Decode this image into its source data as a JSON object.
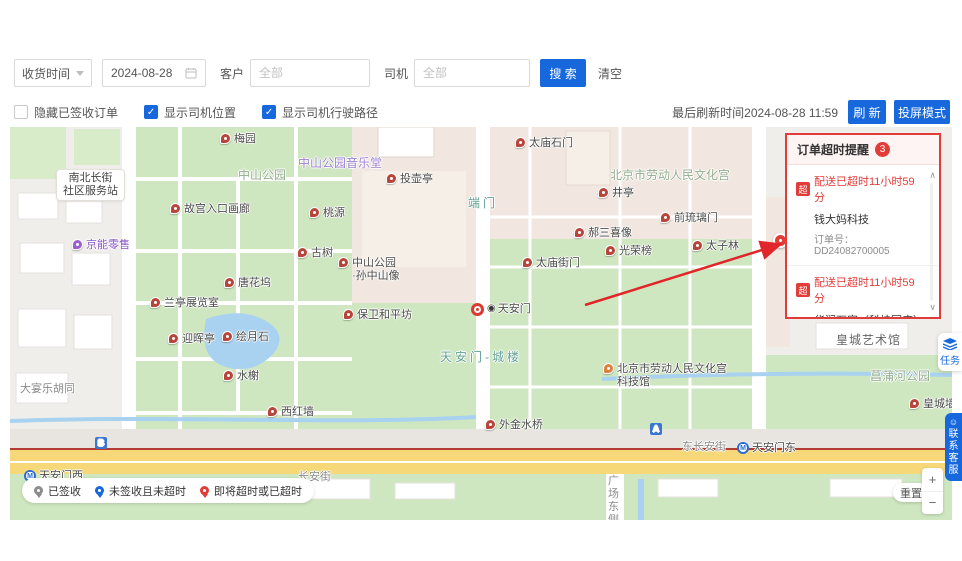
{
  "toolbar": {
    "filter_type": "收货时间",
    "date": "2024-08-28",
    "customer_label": "客户",
    "customer_placeholder": "全部",
    "driver_label": "司机",
    "driver_placeholder": "全部",
    "search_label": "搜 索",
    "clear_label": "清空"
  },
  "options": {
    "hide_signed_label": "隐藏已签收订单",
    "show_location_label": "显示司机位置",
    "show_route_label": "显示司机行驶路径",
    "last_refresh": "最后刷新时间2024-08-28 11:59",
    "refresh_label": "刷 新",
    "cast_label": "投屏模式"
  },
  "alert_panel": {
    "title": "订单超时提醒",
    "count": "3",
    "items": [
      {
        "tag": "超",
        "status": "配送已超时11小时59分",
        "customer": "钱大妈科技",
        "order_no": "订单号：DD24082700005"
      },
      {
        "tag": "超",
        "status": "配送已超时11小时59分",
        "customer": "华润万家（科技园店）2",
        "order_no": "订单号：DD24082700003"
      },
      {
        "tag": "超",
        "status": "剩余0分",
        "customer": "华润万家（科技园店）2",
        "order_no": ""
      }
    ]
  },
  "legend": [
    {
      "label": "已签收",
      "color": "#8c8c8c"
    },
    {
      "label": "未签收且未超时",
      "color": "#1668dc"
    },
    {
      "label": "即将超时或已超时",
      "color": "#e23c39"
    }
  ],
  "side": {
    "task_label": "任务",
    "service_label": "联系客服"
  },
  "controls": {
    "reset_label": "重置"
  },
  "icons": {
    "check": "✓",
    "plus": "+",
    "minus": "−",
    "scroll_up": "∧",
    "scroll_down": "∨",
    "smiley": "☺",
    "metro": "M",
    "attraction": "◉"
  },
  "colors": {
    "primary_blue": "#1668dc",
    "alert_red": "#e23c39",
    "park_green": "#cfe7c0",
    "road_yellow": "#f6d879",
    "river_blue": "#a9d2f1"
  },
  "map": {
    "labels": [
      {
        "t": "area",
        "v": "green",
        "x": 228,
        "y": 42,
        "s": "中山公园",
        "n": "area-label-zhongshan-park"
      },
      {
        "t": "area",
        "v": "purple",
        "x": 288,
        "y": 30,
        "s": "中山公园音乐堂",
        "n": "area-label-concert-hall"
      },
      {
        "t": "area",
        "v": "green",
        "x": 600,
        "y": 42,
        "s": "北京市劳动人民文化宫",
        "n": "area-label-working-peoples-palace"
      },
      {
        "t": "area",
        "v": "teal",
        "x": 458,
        "y": 70,
        "s": "端门",
        "n": "area-label-duanmen"
      },
      {
        "t": "area",
        "v": "teal",
        "x": 430,
        "y": 224,
        "s": "天安门-城楼",
        "n": "area-label-tiananmen-tower"
      },
      {
        "t": "area",
        "v": "green",
        "x": 860,
        "y": 243,
        "s": "菖蒲河公园",
        "n": "area-label-changpu-river-park"
      },
      {
        "t": "area",
        "v": "dark",
        "x": 826,
        "y": 207,
        "s": "皇城艺术馆",
        "n": "area-label-imperial-art-museum"
      },
      {
        "t": "area",
        "v": "street",
        "x": 10,
        "y": 256,
        "s": "大宴乐胡同",
        "n": "street-label-dayanle-hutong"
      },
      {
        "t": "area",
        "v": "street",
        "x": 288,
        "y": 344,
        "s": "长安街",
        "n": "street-label-changan-street"
      },
      {
        "t": "area",
        "v": "street",
        "x": 672,
        "y": 314,
        "s": "东长安街",
        "n": "street-label-east-changan-street"
      },
      {
        "t": "area",
        "v": "vstreet",
        "x": 598,
        "y": 348,
        "s": "广场东侧",
        "n": "street-label-square-east-road"
      },
      {
        "t": "bubble",
        "x": 46,
        "y": 42,
        "s": "南北长街",
        "s2": "社区服务站",
        "n": "bubble-label-community-station"
      },
      {
        "t": "poi",
        "x": 210,
        "y": 6,
        "s": "梅园"
      },
      {
        "t": "poi",
        "x": 376,
        "y": 46,
        "s": "投壶亭"
      },
      {
        "t": "poi",
        "x": 505,
        "y": 10,
        "s": "太庙石门"
      },
      {
        "t": "poi",
        "x": 160,
        "y": 76,
        "s": "故宫入口画廊"
      },
      {
        "t": "poi",
        "x": 299,
        "y": 80,
        "s": "桃源"
      },
      {
        "t": "poi",
        "x": 287,
        "y": 120,
        "s": "古树"
      },
      {
        "t": "poi",
        "x": 214,
        "y": 150,
        "s": "唐花坞"
      },
      {
        "t": "poi",
        "x": 140,
        "y": 170,
        "s": "兰亭展览室"
      },
      {
        "t": "poi",
        "x": 328,
        "y": 130,
        "s": "中山公园",
        "s2": "·孙中山像"
      },
      {
        "t": "poi",
        "x": 333,
        "y": 182,
        "s": "保卫和平坊"
      },
      {
        "t": "poi",
        "x": 158,
        "y": 206,
        "s": "迎晖亭"
      },
      {
        "t": "poi",
        "x": 212,
        "y": 204,
        "s": "绘月石"
      },
      {
        "t": "poi",
        "x": 213,
        "y": 243,
        "s": "水榭"
      },
      {
        "t": "poi",
        "x": 257,
        "y": 279,
        "s": "西红墙"
      },
      {
        "t": "poi",
        "x": 512,
        "y": 130,
        "s": "太庙街门"
      },
      {
        "t": "poi",
        "x": 588,
        "y": 60,
        "s": "井亭"
      },
      {
        "t": "poi",
        "x": 650,
        "y": 85,
        "s": "前琉璃门"
      },
      {
        "t": "poi",
        "x": 564,
        "y": 100,
        "s": "郝三喜像"
      },
      {
        "t": "poi",
        "x": 595,
        "y": 118,
        "s": "光荣榜"
      },
      {
        "t": "poi",
        "x": 682,
        "y": 113,
        "s": "太子林"
      },
      {
        "t": "poi",
        "x": 475,
        "y": 292,
        "s": "外金水桥"
      },
      {
        "t": "poi",
        "v": "orange",
        "x": 593,
        "y": 236,
        "s": "北京市劳动人民文化宫",
        "s2": "科技馆",
        "n": "poi-science-museum"
      },
      {
        "t": "poi",
        "x": 899,
        "y": 271,
        "s": "皇城墙遗址"
      },
      {
        "t": "poi",
        "v": "purple",
        "x": 62,
        "y": 112,
        "s": "京能零售",
        "n": "poi-jingneng-retail"
      },
      {
        "t": "tam",
        "x": 461,
        "y": 176,
        "s": "天安门",
        "n": "poi-tiananmen"
      },
      {
        "t": "metro",
        "x": 727,
        "y": 315,
        "s": "天安门东",
        "n": "metro-station-tiananmen-east"
      },
      {
        "t": "metro",
        "x": 14,
        "y": 343,
        "s": "天安门西",
        "n": "metro-station-tiananmen-west"
      },
      {
        "t": "exit",
        "x": 640,
        "y": 296,
        "s": "A",
        "n": "metro-exit-a"
      },
      {
        "t": "exit",
        "x": 85,
        "y": 310,
        "s": "B",
        "n": "metro-exit-b"
      },
      {
        "t": "marker",
        "x": 763,
        "y": 106,
        "s": "",
        "n": "overtime-order-marker"
      }
    ]
  }
}
